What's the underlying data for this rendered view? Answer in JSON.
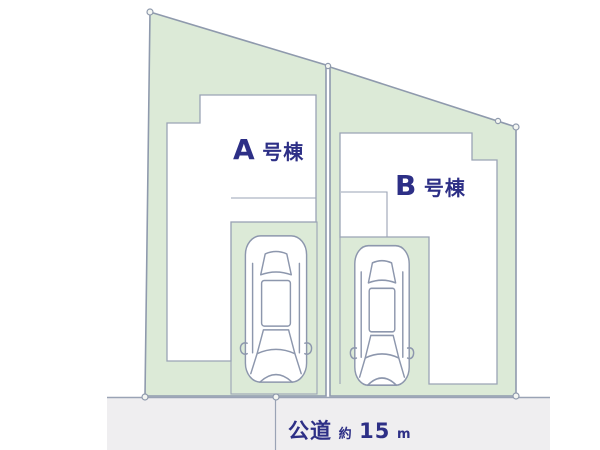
{
  "diagram": {
    "type": "real-estate-lot-layout",
    "lots": [
      {
        "id": "A",
        "building_label": {
          "letter": "A",
          "suffix": "号棟"
        }
      },
      {
        "id": "B",
        "building_label": {
          "letter": "B",
          "suffix": "号棟"
        }
      }
    ],
    "road": {
      "name": "公道",
      "approx_prefix": "約",
      "width_value": "15",
      "unit": "m"
    },
    "colors": {
      "lot_fill": "#dcead7",
      "lot_stroke": "#8f9aad",
      "building_fill": "#ffffff",
      "building_stroke": "#9aa3b5",
      "parking_stroke": "#9aa3b5",
      "car_fill": "#ffffff",
      "car_stroke": "#8d97ad",
      "road_fill": "#efeef0",
      "road_stroke": "#9aa3b5",
      "marker_fill": "#f4f6f2",
      "label_color": "#2d2f86"
    }
  }
}
